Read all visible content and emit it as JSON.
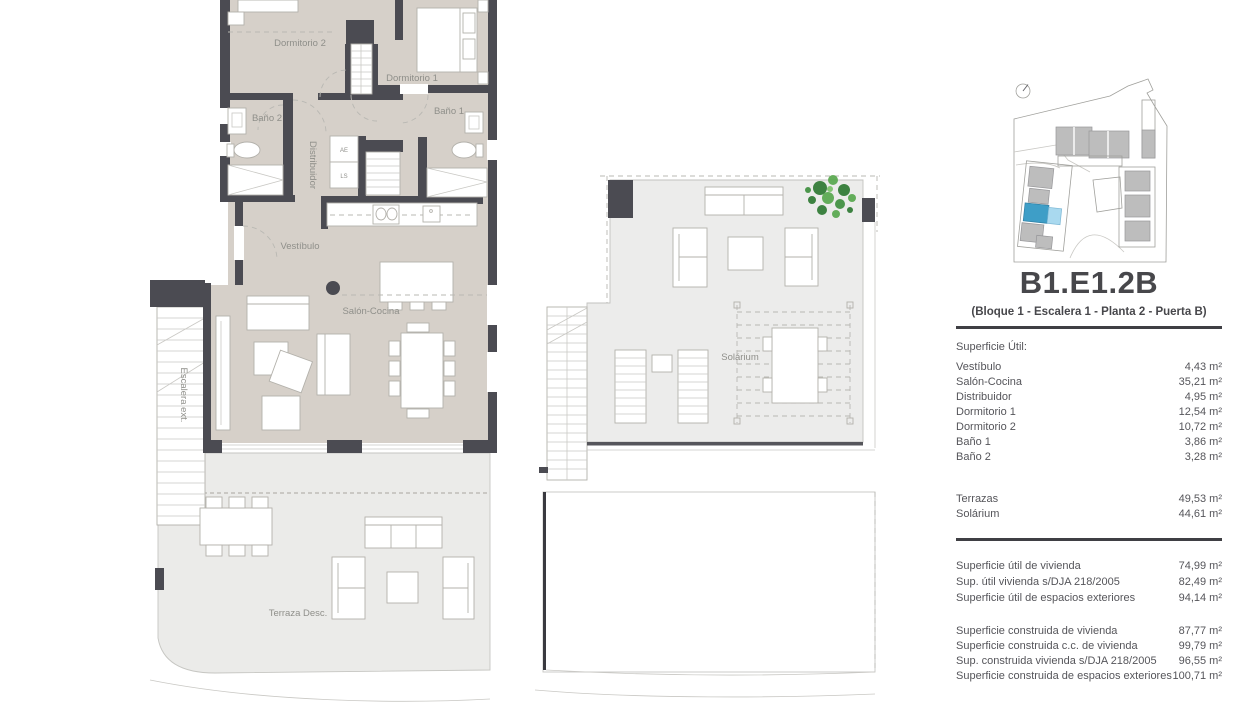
{
  "colors": {
    "wall": "#4b4b52",
    "floor_interior": "#d6d0c9",
    "floor_terrace": "#ebebe9",
    "floor_solarium": "#ececeb",
    "furniture_stroke": "#b3b1ab",
    "plan_label_text": "#8f8f8a",
    "panel_text": "#55555a",
    "divider": "#3f3f44",
    "unit_highlight": "#3e9ec7",
    "unit_highlight_light": "#a9d9ef",
    "building_gray": "#bdbdbd",
    "plant_green": "#3f8f3f"
  },
  "floor_plan": {
    "rooms": {
      "dormitorio_2": "Dormitorio 2",
      "dormitorio_1": "Dormitorio 1",
      "bano_2": "Baño 2",
      "bano_1": "Baño 1",
      "distribuidor": "Distribuidor",
      "closet_ae": "AE",
      "closet_ls": "LS",
      "vestibulo": "Vestíbulo",
      "salon_cocina": "Salón-Cocina",
      "escalera_ext": "Escalera ext.",
      "terraza": "Terraza Desc."
    }
  },
  "solarium_plan": {
    "rooms": {
      "solarium": "Solárium"
    }
  },
  "info_panel": {
    "title": "B1.E1.2B",
    "subtitle": "(Bloque 1 - Escalera 1 - Planta 2 - Puerta B)",
    "section_label": "Superficie Útil:",
    "interior_rows": [
      {
        "label": "Vestíbulo",
        "value": "4,43 m²"
      },
      {
        "label": "Salón-Cocina",
        "value": "35,21 m²"
      },
      {
        "label": "Distribuidor",
        "value": "4,95 m²"
      },
      {
        "label": "Dormitorio 1",
        "value": "12,54 m²"
      },
      {
        "label": "Dormitorio 2",
        "value": "10,72 m²"
      },
      {
        "label": "Baño 1",
        "value": "3,86 m²"
      },
      {
        "label": "Baño 2",
        "value": "3,28 m²"
      }
    ],
    "exterior_rows": [
      {
        "label": "Terrazas",
        "value": "49,53 m²"
      },
      {
        "label": "Solárium",
        "value": "44,61 m²"
      }
    ],
    "summary_rows_1": [
      {
        "label": "Superficie útil de vivienda",
        "value": "74,99 m²"
      },
      {
        "label": "Sup. útil vivienda s/DJA 218/2005",
        "value": "82,49 m²"
      },
      {
        "label": "Superficie útil de espacios exteriores",
        "value": "94,14 m²"
      }
    ],
    "summary_rows_2": [
      {
        "label": "Superficie construida de vivienda",
        "value": "87,77 m²"
      },
      {
        "label": "Superficie construida c.c. de vivienda",
        "value": "99,79 m²"
      },
      {
        "label": "Sup. construida vivienda s/DJA 218/2005",
        "value": "96,55 m²"
      },
      {
        "label": "Superficie construida de espacios exteriores",
        "value": "100,71 m²"
      }
    ]
  }
}
